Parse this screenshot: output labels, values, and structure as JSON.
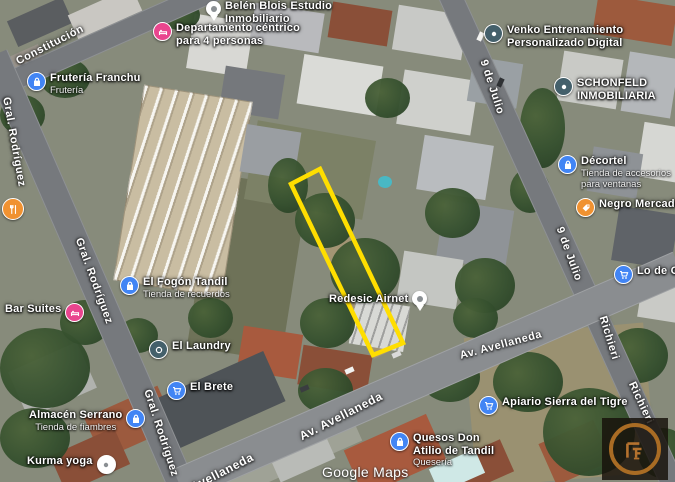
{
  "map": {
    "attribution": "Google Maps",
    "parcel_outline_color": "#FFDE00",
    "icon_colors": {
      "blue": "#4285F4",
      "pink": "#E9458E",
      "orange": "#F09231",
      "slate": "#44606B",
      "logo_bronze": "#B5722E"
    },
    "streets": {
      "constitucion": "Constitución",
      "gral_rodriguez": "Gral. Rodríguez",
      "nueve_de_julio": "9 de Julio",
      "richieri": "Richieri",
      "av_avellaneda": "Av. Avellaneda"
    },
    "places": {
      "fruteria": {
        "title": "Frutería Franchu",
        "subtitle": "Frutería"
      },
      "belen": {
        "line1": "Belén Blois Estudio",
        "line2": "Inmobiliario"
      },
      "departamento": {
        "line1": "Departamento céntrico",
        "line2": "para 4 personas"
      },
      "venko": {
        "line1": "Venko Entrenamiento",
        "line2": "Personalizado Digital"
      },
      "schonfeld": {
        "line1": "SCHONFELD",
        "line2": "INMOBILIARIA"
      },
      "decortel": {
        "title": "Décortel",
        "sub1": "Tienda de accesorios",
        "sub2": "para ventanas"
      },
      "negro_mercado": {
        "title": "Negro Mercado C"
      },
      "lo_de_oli": {
        "title": "Lo de Oli"
      },
      "el_fogon": {
        "title": "El Fogón Tandil",
        "subtitle": "Tienda de recuerdos"
      },
      "bar_suites": {
        "title": "Bar Suites"
      },
      "el_laundry": {
        "title": "El Laundry"
      },
      "el_brete": {
        "title": "El Brete"
      },
      "almacen": {
        "title": "Almacén Serrano",
        "subtitle": "Tienda de fiambres"
      },
      "kurma": {
        "title": "Kurma yoga"
      },
      "quesos": {
        "line1": "Quesos Don",
        "line2": "Atilio de Tandil",
        "subtitle": "Quesería"
      },
      "apiario": {
        "title": "Apiario Sierra del Tigre"
      },
      "redesic": {
        "title": "Redesic  Airnet"
      }
    }
  }
}
